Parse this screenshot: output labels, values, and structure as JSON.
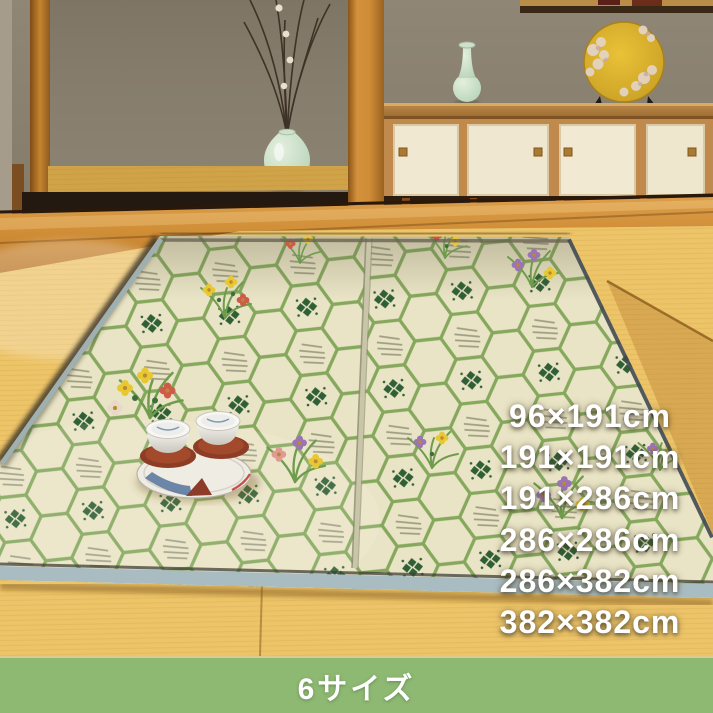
{
  "overlay": {
    "size_options": [
      "96×191cm",
      "191×191cm",
      "191×286cm",
      "286×286cm",
      "286×382cm",
      "382×382cm"
    ],
    "text_color": "#ffffff"
  },
  "banner": {
    "label": "6サイズ",
    "background_color": "#8eb973",
    "text_color": "#ffffff"
  },
  "palette": {
    "tatami_floor": "#edc468",
    "wood_trim": "#c07c2a",
    "wall": "#8a8171",
    "rug_base": "#eae4c6",
    "rug_hex_green": "#7aa252",
    "rug_binding": "#a9bcc2",
    "accent_plate_gold": "#dcae2c",
    "celadon": "#bcd3c2"
  }
}
